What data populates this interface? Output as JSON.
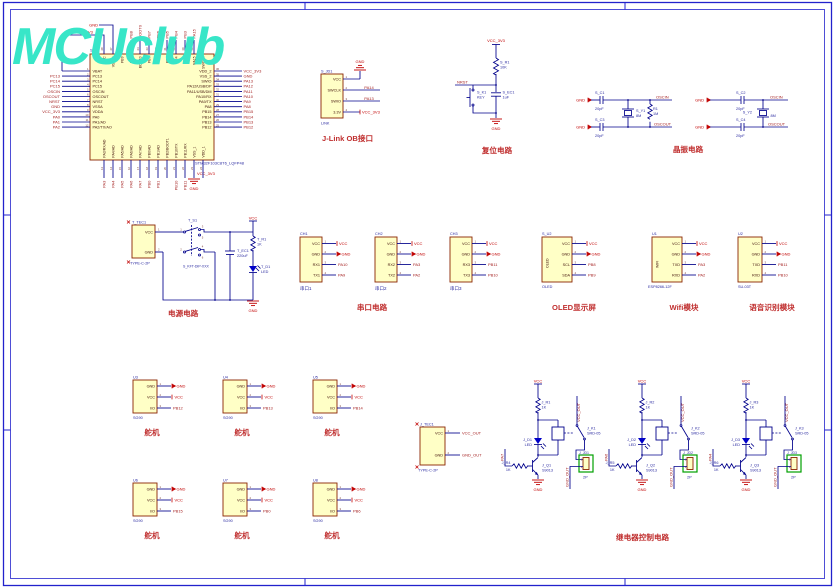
{
  "sheet": {
    "logo": "MCUclub"
  },
  "mcu": {
    "designator": "S_U1",
    "part": "STM32F103C8T6_LQFP48",
    "top_left_gnd": "GND",
    "top_left_vcc": "VCC_3V3",
    "bottom_gnd": "GND",
    "bottom_vcc": "VCC_3V3",
    "left_pins": [
      {
        "num": "1",
        "name": "VBAT",
        "net": ""
      },
      {
        "num": "2",
        "name": "PC13",
        "net": "PC13"
      },
      {
        "num": "3",
        "name": "PC14",
        "net": "PC14"
      },
      {
        "num": "4",
        "name": "PC15",
        "net": "PC15"
      },
      {
        "num": "5",
        "name": "OSCIN",
        "net": "OSCIN"
      },
      {
        "num": "6",
        "name": "OSCOUT",
        "net": "OSCOUT"
      },
      {
        "num": "7",
        "name": "NRST",
        "net": "NRST"
      },
      {
        "num": "8",
        "name": "VSSA",
        "net": "GND"
      },
      {
        "num": "9",
        "name": "VDDA",
        "net": "VCC_3V3"
      },
      {
        "num": "10",
        "name": "PA0",
        "net": "PA0"
      },
      {
        "num": "11",
        "name": "PA1/AD",
        "net": "PA1"
      },
      {
        "num": "12",
        "name": "PA2/TX/AO",
        "net": "PA2"
      }
    ],
    "right_pins": [
      {
        "num": "36",
        "name": "VDD_2",
        "net": "VCC_3V3"
      },
      {
        "num": "35",
        "name": "VSS_2",
        "net": "GND"
      },
      {
        "num": "34",
        "name": "SWIO",
        "net": "PA13"
      },
      {
        "num": "33",
        "name": "PA12/USB/DP",
        "net": "PA12"
      },
      {
        "num": "32",
        "name": "PA11/USB/DM",
        "net": "PA11"
      },
      {
        "num": "31",
        "name": "PA10/RX",
        "net": "PA10"
      },
      {
        "num": "30",
        "name": "PA9/TX",
        "net": "PA9"
      },
      {
        "num": "29",
        "name": "PA8",
        "net": "PA8"
      },
      {
        "num": "28",
        "name": "PB15",
        "net": "PB15"
      },
      {
        "num": "27",
        "name": "PB14",
        "net": "PB14"
      },
      {
        "num": "26",
        "name": "PB13",
        "net": "PB13"
      },
      {
        "num": "25",
        "name": "PB12",
        "net": "PB12"
      }
    ],
    "top_pins": [
      {
        "num": "48",
        "name": "VCC",
        "net": ""
      },
      {
        "num": "47",
        "name": "VSS_3",
        "net": ""
      },
      {
        "num": "46",
        "name": "PB9",
        "net": "PB9"
      },
      {
        "num": "45",
        "name": "PB8",
        "net": "PB8"
      },
      {
        "num": "44",
        "name": "BOOT0",
        "net": "BOOT0"
      },
      {
        "num": "43",
        "name": "PB7",
        "net": "PB7"
      },
      {
        "num": "42",
        "name": "PB6",
        "net": "PB6"
      },
      {
        "num": "41",
        "name": "PB5",
        "net": "PB5"
      },
      {
        "num": "40",
        "name": "PB4",
        "net": "PB4"
      },
      {
        "num": "39",
        "name": "PB3",
        "net": "PB3"
      },
      {
        "num": "38",
        "name": "PA15",
        "net": "PA15"
      },
      {
        "num": "37",
        "name": "SWCLK",
        "net": "PA14"
      }
    ],
    "bottom_pins": [
      {
        "num": "13",
        "name": "PA3/RX/AD",
        "net": "PA3"
      },
      {
        "num": "14",
        "name": "PA4/AD",
        "net": "PA4"
      },
      {
        "num": "15",
        "name": "PA5/AD",
        "net": "PA5"
      },
      {
        "num": "16",
        "name": "PA6/AD",
        "net": "PA6"
      },
      {
        "num": "17",
        "name": "PA7/AD",
        "net": "PA7"
      },
      {
        "num": "18",
        "name": "PB0/AD",
        "net": "PB0"
      },
      {
        "num": "19",
        "name": "PB1/AD",
        "net": "PB1"
      },
      {
        "num": "20",
        "name": "PB2/BOOT1",
        "net": ""
      },
      {
        "num": "21",
        "name": "PB10/TX",
        "net": "PB10"
      },
      {
        "num": "22",
        "name": "PB11/RX",
        "net": "PB11"
      },
      {
        "num": "23",
        "name": "VSS_1",
        "net": ""
      },
      {
        "num": "24",
        "name": "VDD_1",
        "net": ""
      }
    ]
  },
  "jlink": {
    "designator": "S_JD1",
    "part": "LINK",
    "title": "J-Link OB接口",
    "gnd": "GND",
    "pins": [
      {
        "name": "VCC",
        "num": "1",
        "net": "GND"
      },
      {
        "name": "SWCLK",
        "num": "2",
        "net": "PA14"
      },
      {
        "name": "SWIO",
        "num": "3",
        "net": "PA13"
      },
      {
        "name": "3.3V",
        "num": "4",
        "net": "VCC_3V3"
      }
    ]
  },
  "reset": {
    "title": "复位电路",
    "vcc": "VCC_3V3",
    "r_des": "S_R1",
    "r_val": "10K",
    "net": "NRST",
    "key_des": "S_K1",
    "key_val": "KEY",
    "cap_des": "S_EC1",
    "cap_val": "1uF",
    "gnd": "GND"
  },
  "crystal": {
    "title": "晶振电路",
    "left": {
      "gnd1": "GND",
      "gnd2": "GND",
      "c_top_des": "S_C1",
      "c_top_val": "20pF",
      "c_bot_des": "S_C3",
      "c_bot_val": "20pF",
      "y_des": "S_Y1",
      "y_val": "8M",
      "r_des": "R1",
      "r_val": "1M",
      "net_top": "OSCIN",
      "net_bot": "OSCOUT"
    },
    "right": {
      "gnd1": "GND",
      "gnd2": "GND",
      "c_top_des": "S_C2",
      "c_top_val": "20pF",
      "c_bot_des": "S_C4",
      "c_bot_val": "20pF",
      "y_des": "S_Y2",
      "y_val": "8M",
      "net_top": "OSCIN",
      "net_bot": "OSCOUT"
    }
  },
  "power": {
    "title": "电源电路",
    "tec_des": "T_TEC1",
    "tec_part": "TYPE-C-2P",
    "pin_vcc": "VCC",
    "pin_gnd": "GND",
    "num1": "1",
    "num2": "2",
    "sw_des": "T_S1",
    "sw_part": "S_KFT-DIP-XXX",
    "sw_nums": [
      "1",
      "2",
      "3",
      "4",
      "5",
      "6"
    ],
    "cap_des": "T_EC1",
    "cap_val": "220uF",
    "vcc": "VCC",
    "r_des": "T_R1",
    "r_val": "1K",
    "led_des": "T_D1",
    "led_val": "LED",
    "gnd": "GND"
  },
  "serial": {
    "title": "串口电路",
    "connectors": [
      {
        "des": "CH1",
        "label": "串口1",
        "p1": "VCC",
        "p2": "GND",
        "p3": "RX1",
        "p4": "TX1",
        "n1": "1",
        "n2": "2",
        "n3": "3",
        "n4": "4",
        "net1": "VCC",
        "net2": "GND",
        "net3": "PA10",
        "net4": "PA9"
      },
      {
        "des": "CH2",
        "label": "串口2",
        "p1": "VCC",
        "p2": "GND",
        "p3": "RX2",
        "p4": "TX2",
        "n1": "1",
        "n2": "2",
        "n3": "3",
        "n4": "4",
        "net1": "VCC",
        "net2": "GND",
        "net3": "PA3",
        "net4": "PA2"
      },
      {
        "des": "CH3",
        "label": "串口3",
        "p1": "VCC",
        "p2": "GND",
        "p3": "RX3",
        "p4": "TX3",
        "n1": "1",
        "n2": "2",
        "n3": "3",
        "n4": "4",
        "net1": "VCC",
        "net2": "GND",
        "net3": "PB11",
        "net4": "PB10"
      }
    ]
  },
  "oled": {
    "title": "OLED显示屏",
    "des": "S_U2",
    "part": "OLED",
    "vertical": "OLED",
    "p1": "VCC",
    "p2": "GND",
    "p3": "SCL",
    "p4": "SDA",
    "n1": "1",
    "n2": "2",
    "n3": "3",
    "n4": "4",
    "net1": "VCC",
    "net2": "GND",
    "net3": "PB8",
    "net4": "PB9"
  },
  "wifi": {
    "title": "Wifi模块",
    "des": "U1",
    "part": "ESP8266-12F",
    "vertical": "WIFI",
    "p1": "VCC",
    "p2": "GND",
    "p3": "TXD",
    "p4": "RXD",
    "n1": "1",
    "n2": "2",
    "n3": "3",
    "n4": "4",
    "net1": "VCC",
    "net2": "GND",
    "net3": "PA3",
    "net4": "PA2"
  },
  "voice": {
    "title": "语音识别模块",
    "des": "U2",
    "part": "SU-03T",
    "p1": "VCC",
    "p2": "GND",
    "p3": "TXD",
    "p4": "RXD",
    "n1": "1",
    "n2": "2",
    "n3": "3",
    "n4": "4",
    "net1": "VCC",
    "net2": "GND",
    "net3": "PB11",
    "net4": "PB10"
  },
  "servo": {
    "title": "舵机",
    "part": "SG90",
    "p1": "GND",
    "p2": "VCC",
    "p3": "I/O",
    "n1": "1",
    "n2": "2",
    "n3": "3",
    "net1": "GND",
    "net2": "VCC",
    "row1": [
      {
        "des": "U3",
        "net": "PB12"
      },
      {
        "des": "U4",
        "net": "PB13"
      },
      {
        "des": "U5",
        "net": "PB14"
      }
    ],
    "row2": [
      {
        "des": "U6",
        "net": "PB15"
      },
      {
        "des": "U7",
        "net": "PB0"
      },
      {
        "des": "U8",
        "net": "PB6"
      }
    ]
  },
  "relay": {
    "title": "继电器控制电路",
    "tec_des": "J_TEC1",
    "tec_part": "TYPE-C-2P",
    "pin_vcc": "VCC",
    "pin_gnd": "GND",
    "num1": "1",
    "num2": "2",
    "net_vcc": "VCC_OUT",
    "net_gnd": "GND_OUT",
    "vcc": "VCC",
    "gnd": "GND",
    "r_val": "1K",
    "rb_val": "1K",
    "led": "LED",
    "relay_part": "SRD-05",
    "conn_val": "2P",
    "q_part": "S9013",
    "vcc_out": "VCC_OUT",
    "gnd_out": "GND_OUT",
    "nums": [
      "1",
      "2"
    ],
    "channels": [
      {
        "r": "J_R1",
        "d": "J_D1",
        "k": "J_K1",
        "jd": "J_JD1",
        "q": "J_Q1",
        "rb": "J_R4",
        "net": "PA7"
      },
      {
        "r": "J_R2",
        "d": "J_D2",
        "k": "J_K2",
        "jd": "J_JD2",
        "q": "J_Q2",
        "rb": "J_R5",
        "net": "PA6"
      },
      {
        "r": "J_R3",
        "d": "J_D3",
        "k": "J_K3",
        "jd": "J_JD3",
        "q": "J_Q3",
        "rb": "J_R6",
        "net": "PA4"
      }
    ]
  }
}
